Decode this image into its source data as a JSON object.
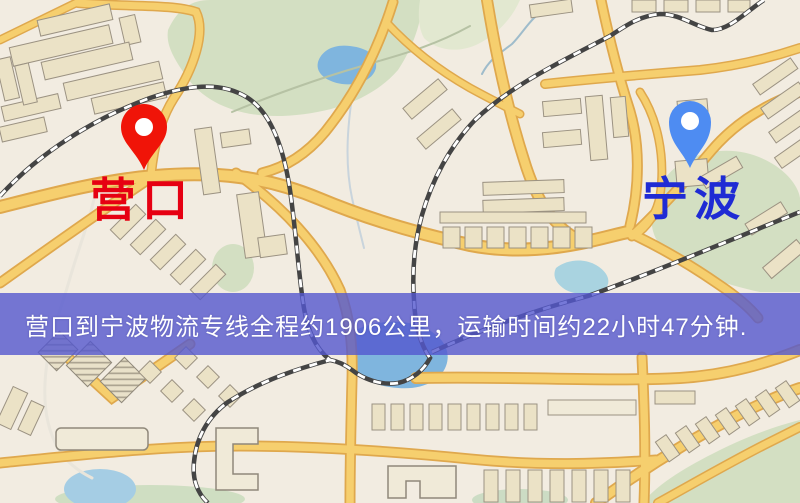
{
  "map": {
    "origin_marker": {
      "label": "营口",
      "pin_color": "#f01408",
      "label_color": "#e60012"
    },
    "destination_marker": {
      "label": "宁波",
      "pin_color": "#4e8cf2",
      "label_color": "#1f2bd4"
    },
    "banner": {
      "text": "营口到宁波物流专线全程约1906公里，运输时间约22小时47分钟.",
      "background_color": "#5458ce",
      "text_color": "#ffffff"
    },
    "palette": {
      "background": "#f2ece1",
      "road_fill": "#f6cf6e",
      "road_casing": "#dfa84d",
      "park_green": "#d3dfc2",
      "water_blue": "#7fb5de",
      "building_beige": "#ebe2c6",
      "railway_dark": "#444444"
    }
  }
}
